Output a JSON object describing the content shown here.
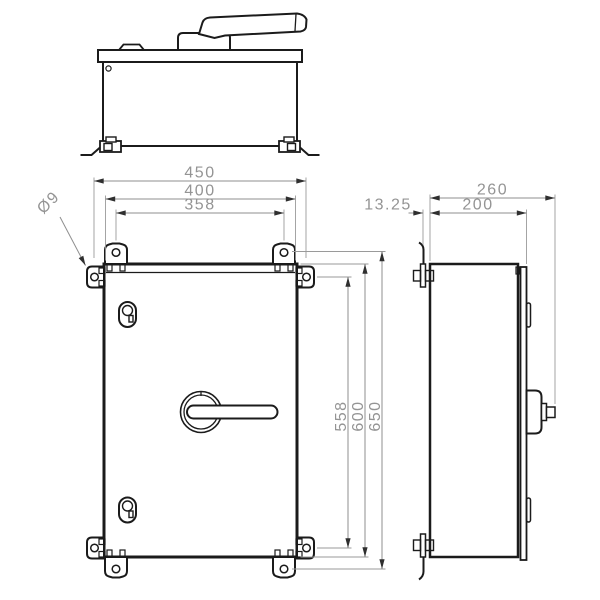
{
  "drawing": {
    "dimensions": {
      "width_overall": "450",
      "width_body": "400",
      "width_hole_spacing": "358",
      "hole_diameter": "Ø9",
      "depth_overall": "260",
      "depth_body": "200",
      "bracket_offset": "13.25",
      "height_hole_spacing_side": "558",
      "height_body": "600",
      "height_hole_spacing": "650"
    },
    "colors": {
      "object_line": "#1b1b1b",
      "dimension_line": "#8f8f8f",
      "dimension_text": "#949494",
      "background": "#ffffff"
    }
  }
}
